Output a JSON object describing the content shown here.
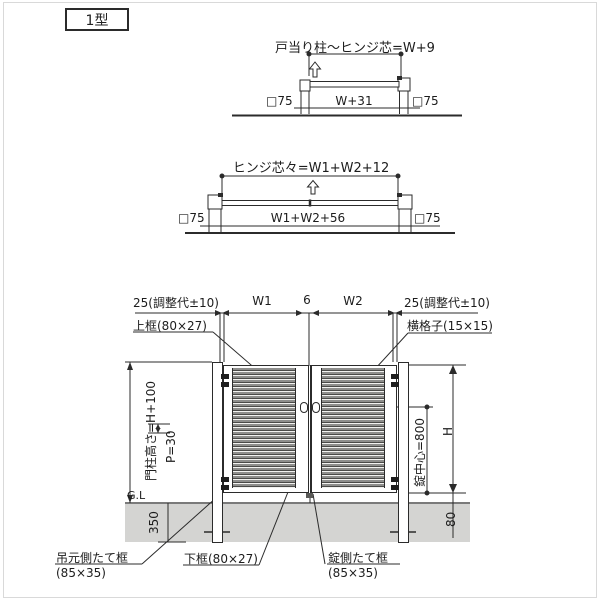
{
  "type_label": "1型",
  "plan_single": {
    "title": "戸当り柱〜ヒンジ芯=W+9",
    "dim_left": "□75",
    "dim_center": "W+31",
    "dim_right": "□75"
  },
  "plan_double": {
    "title": "ヒンジ芯々=W1+W2+12",
    "dim_left": "□75",
    "dim_center": "W1+W2+56",
    "dim_right": "□75"
  },
  "elevation": {
    "top_dims": {
      "left_adjust": "25(調整代±10)",
      "w1": "W1",
      "gap": "6",
      "w2": "W2",
      "right_adjust": "25(調整代±10)"
    },
    "labels": {
      "top_rail": "上框(80×27)",
      "cross_bar": "横格子(15×15)",
      "post_height": "門柱高さ=H+100",
      "pitch": "P=30",
      "ground_line": "G.L",
      "embed_depth": "350",
      "lock_center": "錠中心=800",
      "height": "H",
      "bottom_clearance": "80",
      "hinge_stile": "吊元側たて框",
      "hinge_stile_size": "(85×35)",
      "bottom_rail": "下框(80×27)",
      "lock_stile": "錠側たて框",
      "lock_stile_size": "(85×35)"
    }
  },
  "colors": {
    "line": "#2b2b2b",
    "ground_fill": "#d4d4d2",
    "louvre_gray": "#8e8e8c",
    "louvre_dark": "#4a4a48",
    "louvre_light": "#f2f2f0"
  }
}
